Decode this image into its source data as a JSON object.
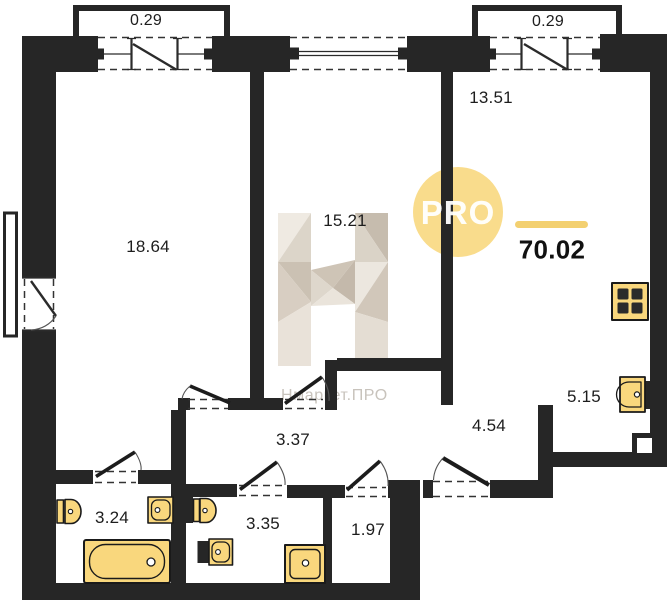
{
  "plan": {
    "width": 667,
    "height": 600,
    "type": "apartment-floor-plan"
  },
  "total": {
    "area": "70.02",
    "pos": {
      "x": 552,
      "y": 250
    }
  },
  "rooms": [
    {
      "name": "bedroom",
      "area": "18.64",
      "pos": {
        "x": 148,
        "y": 247
      }
    },
    {
      "name": "room",
      "area": "15.21",
      "pos": {
        "x": 345,
        "y": 221
      }
    },
    {
      "name": "living-room",
      "area": "13.51",
      "pos": {
        "x": 491,
        "y": 98
      }
    },
    {
      "name": "kitchen",
      "area": "5.15",
      "pos": {
        "x": 584,
        "y": 397
      }
    },
    {
      "name": "hallway",
      "area": "3.37",
      "pos": {
        "x": 293,
        "y": 440
      }
    },
    {
      "name": "entry-hall",
      "area": "4.54",
      "pos": {
        "x": 489,
        "y": 426
      }
    },
    {
      "name": "bathroom-1",
      "area": "3.24",
      "pos": {
        "x": 112,
        "y": 518
      }
    },
    {
      "name": "bathroom-2",
      "area": "3.35",
      "pos": {
        "x": 263,
        "y": 524
      }
    },
    {
      "name": "wardrobe",
      "area": "1.97",
      "pos": {
        "x": 368,
        "y": 530
      }
    },
    {
      "name": "balcony-left",
      "area": "0.29",
      "pos": {
        "x": 146,
        "y": 21
      }
    },
    {
      "name": "balcony-right",
      "area": "0.29",
      "pos": {
        "x": 548,
        "y": 22
      }
    }
  ],
  "watermark": {
    "badge_text": "PRO",
    "brand_letter": "Н",
    "brand_text": "Нмаркет.ПРО"
  },
  "icons": {
    "stove": "4-burner-cooktop",
    "kitchen_sink": "kitchen-sink",
    "toilet": "toilet",
    "washbasin": "washbasin",
    "bathtub": "bathtub",
    "shower": "shower-tray"
  },
  "colors": {
    "wall": "#262626",
    "fixture_fill": "#F9D77D",
    "fixture_border": "#1A1A1A",
    "background": "#FFFFFF",
    "label_text": "#1D1D1D",
    "accent_line": "#F3D070",
    "badge_fill": "#F8D87F",
    "badge_text": "#FFFFFF",
    "brand_text": "#C8C3BC",
    "dash": "#333333"
  }
}
